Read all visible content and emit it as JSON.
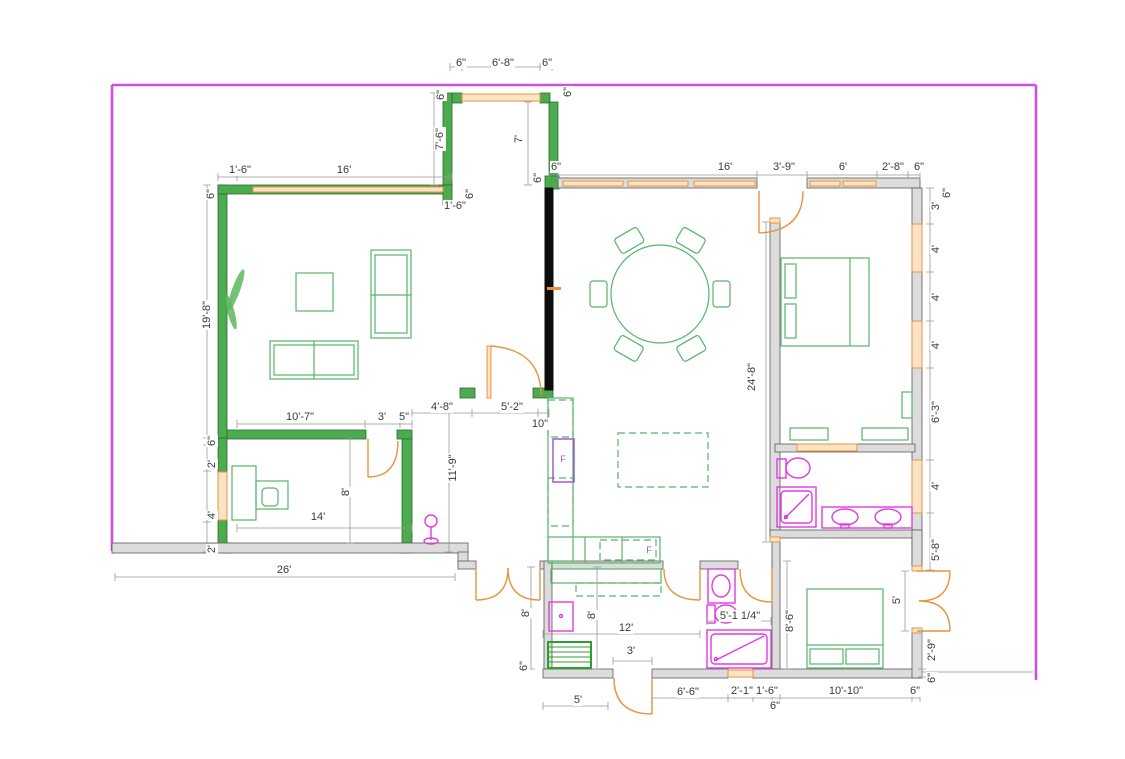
{
  "colors": {
    "wall-green": "#4caa4f",
    "wall-green-edge": "#2b6e2e",
    "wall-gray": "#dcdcdc",
    "selected-black": "#0d0d0d",
    "window-fill": "#fbe3c8",
    "window-stroke": "#e8943a",
    "door-orange": "#e8943a",
    "furniture-green": "#57b36b",
    "fixture-magenta": "#e23ae2",
    "boundary-purple": "#cb4fe0"
  },
  "dimension_labels": [
    {
      "t": "6\"",
      "x": 461,
      "y": 63,
      "r": 0
    },
    {
      "t": "6'-8\"",
      "x": 503,
      "y": 63,
      "r": 0
    },
    {
      "t": "6\"",
      "x": 547,
      "y": 63,
      "r": 0
    },
    {
      "t": "6\"",
      "x": 441,
      "y": 95,
      "r": 90
    },
    {
      "t": "6\"",
      "x": 568,
      "y": 92,
      "r": 90
    },
    {
      "t": "7'-6\"",
      "x": 440,
      "y": 139,
      "r": 90
    },
    {
      "t": "7'",
      "x": 519,
      "y": 139,
      "r": 90
    },
    {
      "t": "6\"",
      "x": 538,
      "y": 178,
      "r": 90
    },
    {
      "t": "1'-6\"",
      "x": 240,
      "y": 170,
      "r": 0
    },
    {
      "t": "16'",
      "x": 344,
      "y": 170,
      "r": 0
    },
    {
      "t": "6\"",
      "x": 211,
      "y": 194,
      "r": 90
    },
    {
      "t": "1'-6\"",
      "x": 455,
      "y": 206,
      "r": 0
    },
    {
      "t": "6\"",
      "x": 470,
      "y": 194,
      "r": 90
    },
    {
      "t": "6\"",
      "x": 556,
      "y": 167,
      "r": 0
    },
    {
      "t": "16'",
      "x": 725,
      "y": 167,
      "r": 0
    },
    {
      "t": "3'-9\"",
      "x": 784,
      "y": 167,
      "r": 0
    },
    {
      "t": "6'",
      "x": 843,
      "y": 167,
      "r": 0
    },
    {
      "t": "2'-8\"",
      "x": 893,
      "y": 167,
      "r": 0
    },
    {
      "t": "6\"",
      "x": 919,
      "y": 167,
      "r": 0
    },
    {
      "t": "6\"",
      "x": 947,
      "y": 193,
      "r": 90
    },
    {
      "t": "3'",
      "x": 936,
      "y": 206,
      "r": 90
    },
    {
      "t": "4'",
      "x": 936,
      "y": 249,
      "r": 90
    },
    {
      "t": "4'",
      "x": 936,
      "y": 297,
      "r": 90
    },
    {
      "t": "4'",
      "x": 936,
      "y": 345,
      "r": 90
    },
    {
      "t": "6'-3\"",
      "x": 936,
      "y": 412,
      "r": 90
    },
    {
      "t": "4'",
      "x": 936,
      "y": 486,
      "r": 90
    },
    {
      "t": "5'-8\"",
      "x": 936,
      "y": 550,
      "r": 90
    },
    {
      "t": "19'-8\"",
      "x": 207,
      "y": 315,
      "r": 90
    },
    {
      "t": "6\"",
      "x": 212,
      "y": 441,
      "r": 90
    },
    {
      "t": "2'",
      "x": 212,
      "y": 464,
      "r": 90
    },
    {
      "t": "4'",
      "x": 212,
      "y": 515,
      "r": 90
    },
    {
      "t": "2'",
      "x": 212,
      "y": 549,
      "r": 90
    },
    {
      "t": "24'-8\"",
      "x": 752,
      "y": 377,
      "r": 90
    },
    {
      "t": "10'-7\"",
      "x": 300,
      "y": 417,
      "r": 0
    },
    {
      "t": "3'",
      "x": 382,
      "y": 417,
      "r": 0
    },
    {
      "t": "5\"",
      "x": 404,
      "y": 417,
      "r": 0
    },
    {
      "t": "4'-8\"",
      "x": 442,
      "y": 407,
      "r": 0
    },
    {
      "t": "5'-2\"",
      "x": 512,
      "y": 407,
      "r": 0
    },
    {
      "t": "10\"",
      "x": 540,
      "y": 424,
      "r": 0
    },
    {
      "t": "11'-9\"",
      "x": 453,
      "y": 468,
      "r": 90
    },
    {
      "t": "8'",
      "x": 346,
      "y": 492,
      "r": 90
    },
    {
      "t": "14'",
      "x": 318,
      "y": 517,
      "r": 0
    },
    {
      "t": "26'",
      "x": 284,
      "y": 570,
      "r": 0
    },
    {
      "t": "8'",
      "x": 526,
      "y": 613,
      "r": 90
    },
    {
      "t": "6\"",
      "x": 524,
      "y": 666,
      "r": 90
    },
    {
      "t": "8'",
      "x": 592,
      "y": 615,
      "r": 90
    },
    {
      "t": "12'",
      "x": 626,
      "y": 628,
      "r": 0
    },
    {
      "t": "3'",
      "x": 631,
      "y": 651,
      "r": 0
    },
    {
      "t": "5'",
      "x": 578,
      "y": 700,
      "r": 0
    },
    {
      "t": "6'-6\"",
      "x": 688,
      "y": 692,
      "r": 0
    },
    {
      "t": "5'-1 1/4\"",
      "x": 740,
      "y": 616,
      "r": 0
    },
    {
      "t": "2'-1\"",
      "x": 742,
      "y": 691,
      "r": 0
    },
    {
      "t": "1'-6\"",
      "x": 767,
      "y": 691,
      "r": 0
    },
    {
      "t": "6\"",
      "x": 775,
      "y": 706,
      "r": 0
    },
    {
      "t": "8'-6\"",
      "x": 790,
      "y": 621,
      "r": 90
    },
    {
      "t": "10'-10\"",
      "x": 846,
      "y": 691,
      "r": 0
    },
    {
      "t": "6\"",
      "x": 915,
      "y": 691,
      "r": 0
    },
    {
      "t": "5'",
      "x": 897,
      "y": 600,
      "r": 90
    },
    {
      "t": "2'-9\"",
      "x": 932,
      "y": 650,
      "r": 90
    },
    {
      "t": "6\"",
      "x": 932,
      "y": 678,
      "r": 90
    }
  ],
  "appliance_labels": [
    {
      "t": "F",
      "x": 563,
      "y": 459,
      "c": "#b84fd8"
    },
    {
      "t": "F",
      "x": 649,
      "y": 550,
      "c": "#6a6ad8"
    }
  ]
}
